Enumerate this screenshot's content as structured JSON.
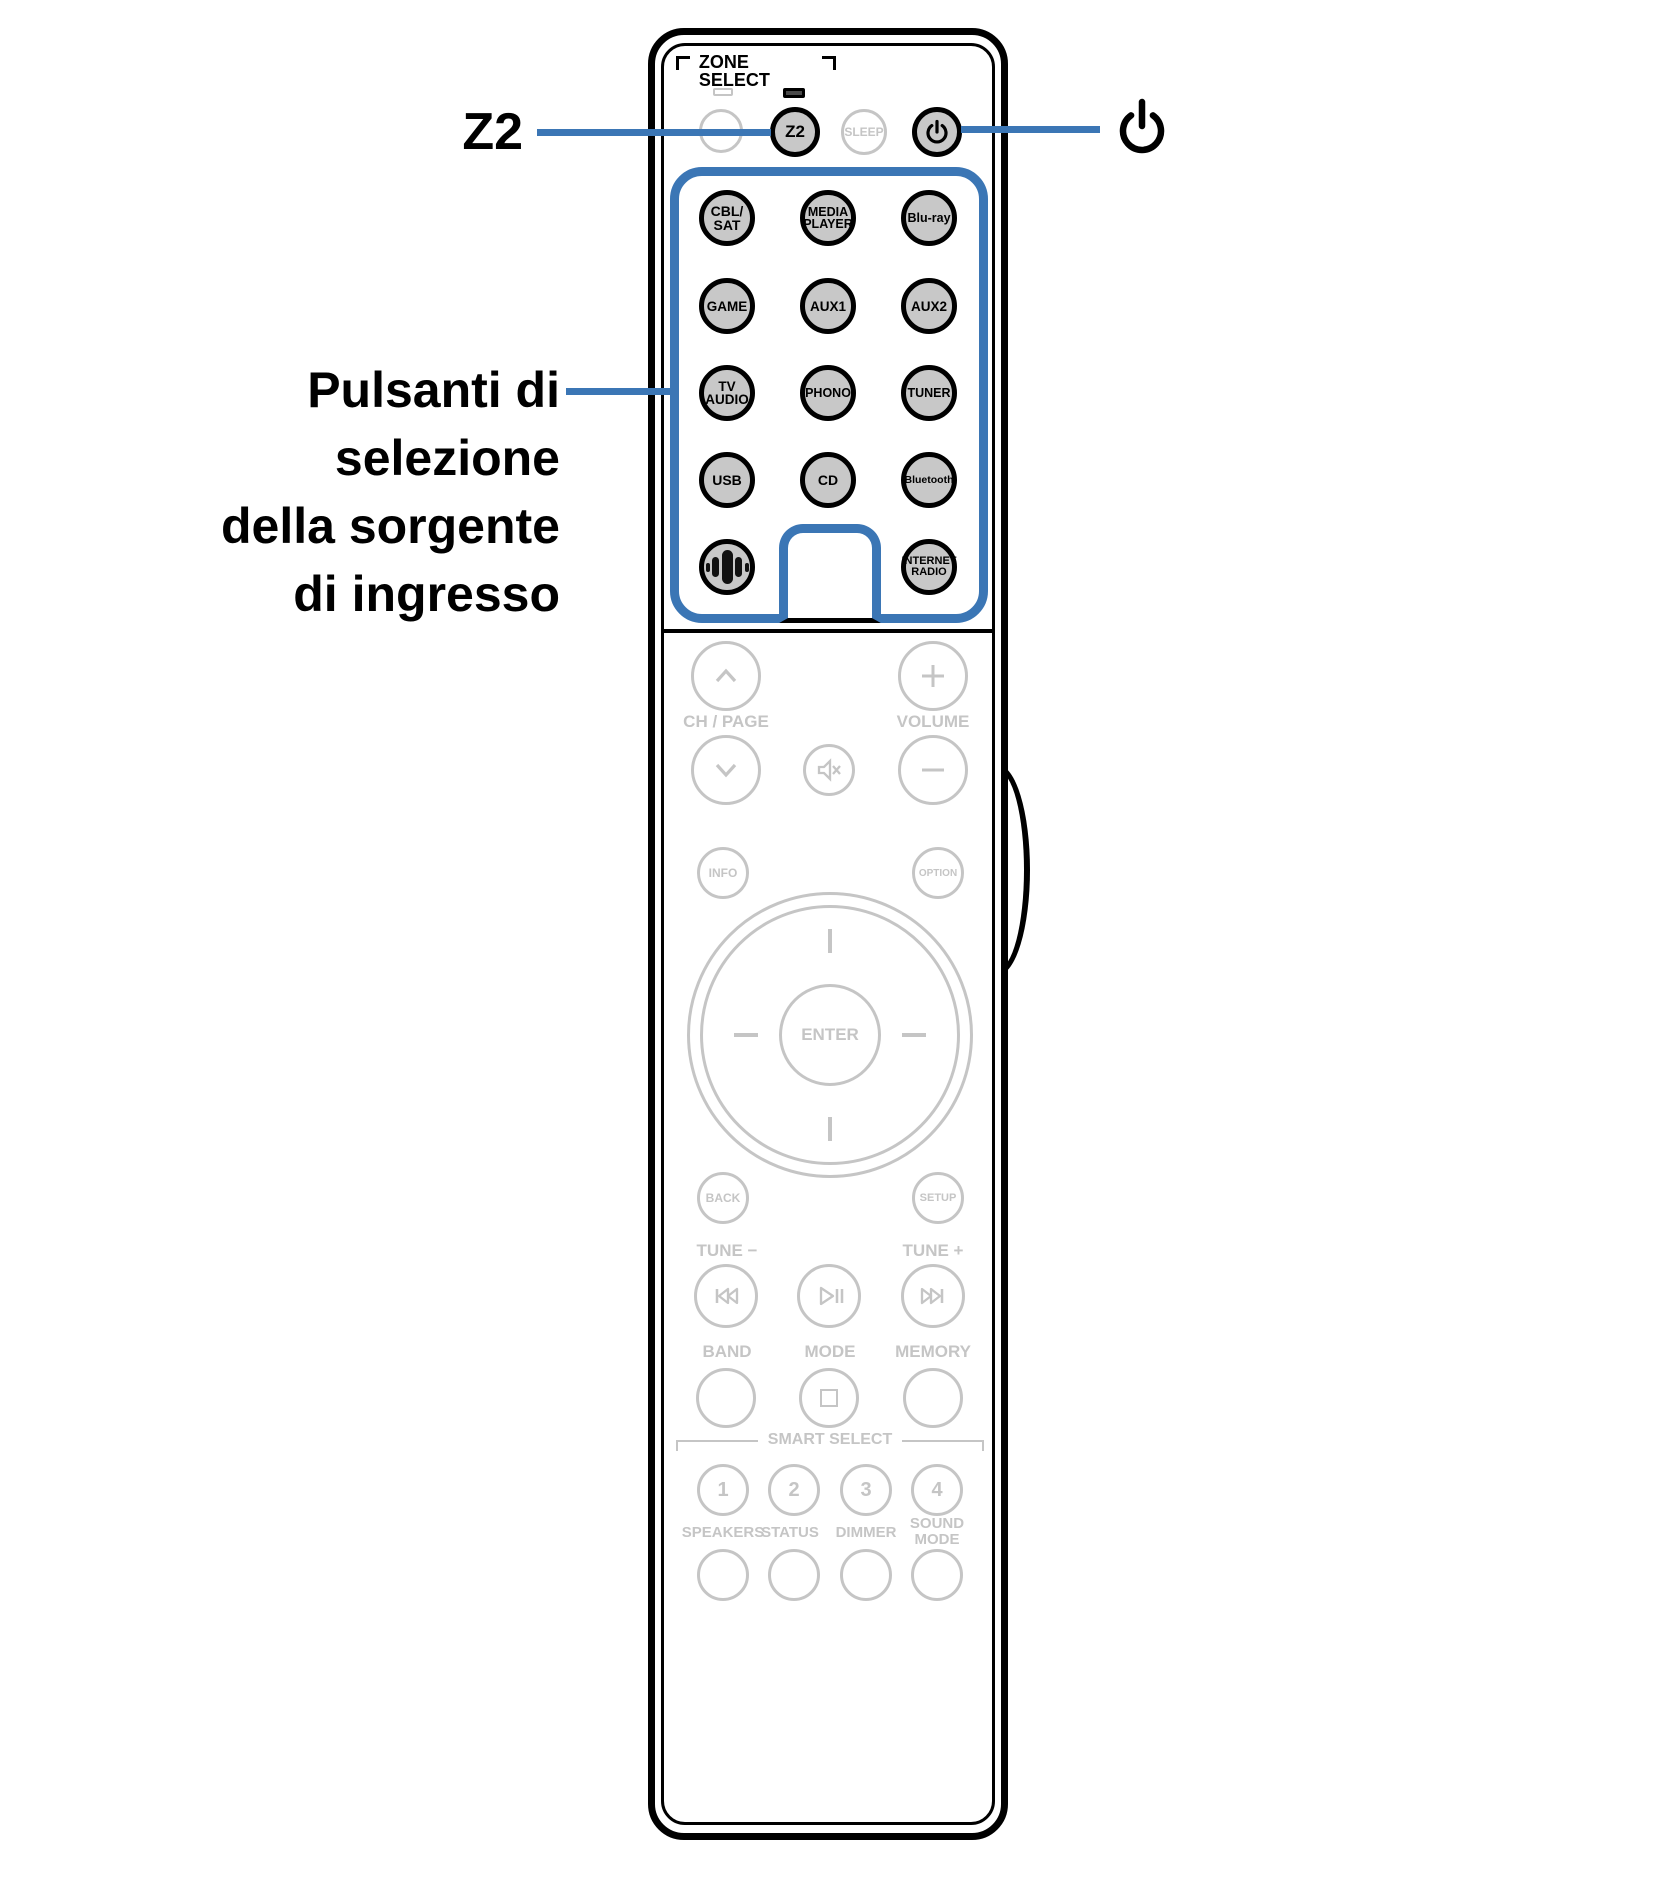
{
  "colors": {
    "accent_blue": "#3b76b5",
    "button_fill_gray": "#c8c8c8",
    "faded_gray": "#c5c5c5",
    "outline_black": "#000000"
  },
  "callouts": {
    "z2": "Z2",
    "source": "Pulsanti di\nselezione\ndella sorgente\ndi ingresso"
  },
  "remote": {
    "zone_select": "ZONE SELECT",
    "z2": "Z2",
    "sleep": "SLEEP",
    "sources": [
      "CBL/\nSAT",
      "MEDIA\nPLAYER",
      "Blu-ray",
      "GAME",
      "AUX1",
      "AUX2",
      "TV\nAUDIO",
      "PHONO",
      "TUNER",
      "USB",
      "CD",
      "Bluetooth",
      "INTERNET\nRADIO"
    ],
    "ch_page": "CH / PAGE",
    "volume": "VOLUME",
    "info": "INFO",
    "option": "OPTION",
    "enter": "ENTER",
    "back": "BACK",
    "setup": "SETUP",
    "tune_minus": "TUNE −",
    "tune_plus": "TUNE +",
    "band": "BAND",
    "mode": "MODE",
    "memory": "MEMORY",
    "smart_select": "SMART SELECT",
    "smart": [
      "1",
      "2",
      "3",
      "4"
    ],
    "speakers": "SPEAKERS",
    "status": "STATUS",
    "dimmer": "DIMMER",
    "sound_mode": "SOUND\nMODE"
  }
}
